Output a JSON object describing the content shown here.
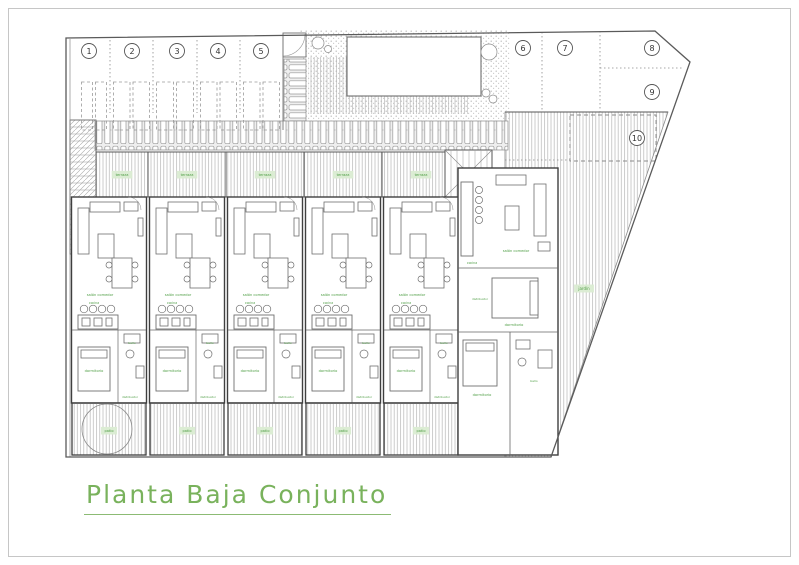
{
  "title": {
    "text": "Planta Baja Conjunto"
  },
  "parking": {
    "space_numbers": [
      "1",
      "2",
      "3",
      "4",
      "5",
      "6",
      "7",
      "8",
      "9",
      "10"
    ]
  },
  "room_labels": {
    "terrace": "terraza",
    "living": "salón comedor",
    "kitchen": "cocina",
    "bedroom": "dormitorio",
    "bath": "baño",
    "hall": "distribuidor",
    "patio": "patio",
    "garden": "jardín"
  },
  "colors": {
    "title_green": "#79b25c",
    "label_green": "#4f9e45",
    "label_bg": "#daecd2",
    "wall": "#3f3f3f",
    "hatch": "#b5b5b5",
    "frame": "#c6c6c6"
  }
}
